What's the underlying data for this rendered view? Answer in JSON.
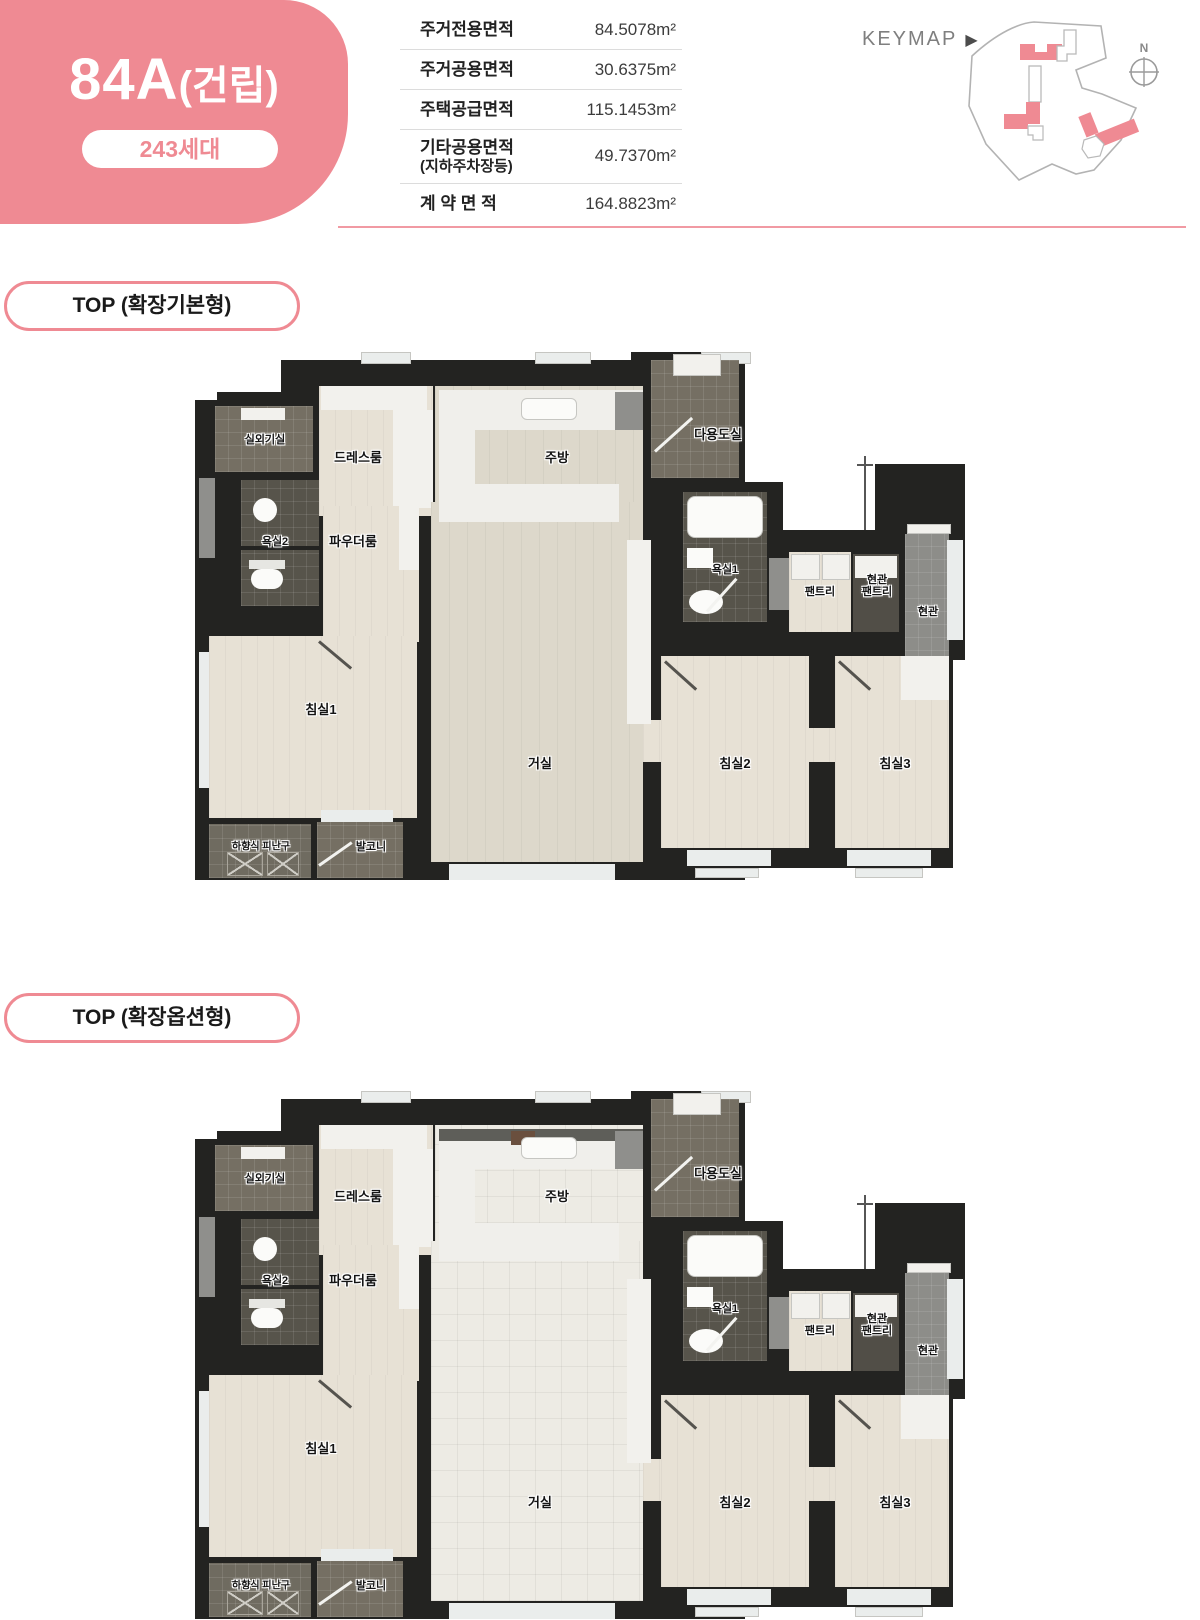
{
  "page": {
    "accent": "#ef8a93"
  },
  "header": {
    "unit_title_main": "84A",
    "unit_title_paren": "(건립)",
    "units_badge": "243세대",
    "area_table": {
      "rows": [
        {
          "label": "주거전용면적",
          "label2": "",
          "value": "84.5078m²"
        },
        {
          "label": "주거공용면적",
          "label2": "",
          "value": "30.6375m²"
        },
        {
          "label": "주택공급면적",
          "label2": "",
          "value": "115.1453m²"
        },
        {
          "label": "기타공용면적",
          "label2": "(지하주차장등)",
          "value": "49.7370m²"
        },
        {
          "label": "계 약 면 적",
          "label2": "",
          "value": "164.8823m²"
        }
      ]
    },
    "keymap": {
      "label": "KEYMAP",
      "arrow": "▶",
      "compass_n": "N"
    }
  },
  "plans": {
    "plan1_title": "TOP (확장기본형)",
    "plan2_title": "TOP (확장옵션형)"
  },
  "rooms": {
    "outdoor_unit": "실외기실",
    "dress_room": "드레스룸",
    "kitchen": "주방",
    "utility": "다용도실",
    "bath2": "욕실2",
    "powder_room": "파우더룸",
    "bath1": "욕실1",
    "pantry": "팬트리",
    "entry_pantry_line1": "현관",
    "entry_pantry_line2": "팬트리",
    "entry": "현관",
    "bed1": "침실1",
    "living": "거실",
    "bed2": "침실2",
    "bed3": "침실3",
    "escape_hatch": "하향식 피난구",
    "balcony": "발코니"
  }
}
